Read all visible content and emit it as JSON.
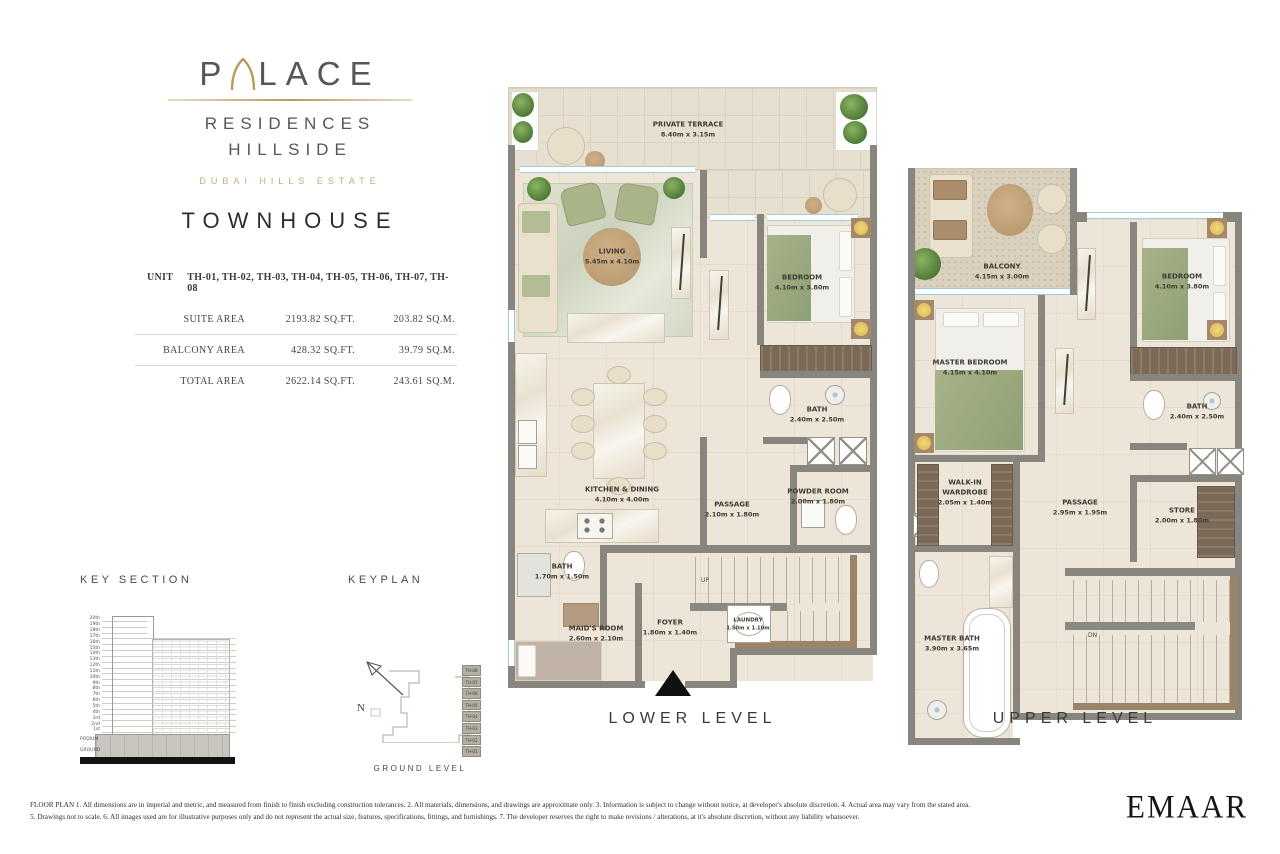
{
  "brand": {
    "logo_start": "P",
    "logo_end": "LACE",
    "line1": "RESIDENCES",
    "line2": "HILLSIDE",
    "estate": "DUBAI HILLS ESTATE",
    "product": "TOWNHOUSE"
  },
  "unit_table": {
    "unit_label": "UNIT",
    "unit_values": "TH-01, TH-02, TH-03, TH-04, TH-05, TH-06, TH-07, TH-08",
    "rows": [
      {
        "label": "SUITE AREA",
        "sqft": "2193.82 SQ.FT.",
        "sqm": "203.82 SQ.M."
      },
      {
        "label": "BALCONY AREA",
        "sqft": "428.32 SQ.FT.",
        "sqm": "39.79 SQ.M."
      },
      {
        "label": "TOTAL AREA",
        "sqft": "2622.14 SQ.FT.",
        "sqm": "243.61 SQ.M."
      }
    ]
  },
  "key_section": {
    "title": "KEY SECTION",
    "floors": [
      "20th",
      "19th",
      "18th",
      "17th",
      "16th",
      "15th",
      "14th",
      "13th",
      "12th",
      "11th",
      "10th",
      "9th",
      "8th",
      "7th",
      "6th",
      "5th",
      "4th",
      "3rd",
      "2nd",
      "1st",
      "PODIUM",
      "GROUND"
    ]
  },
  "keyplan": {
    "title": "KEYPLAN",
    "north_label": "N",
    "caption": "GROUND LEVEL",
    "units": [
      "TH-08",
      "TH-07",
      "TH-06",
      "TH-05",
      "TH-04",
      "TH-03",
      "TH-02",
      "TH-01"
    ]
  },
  "lower_level": {
    "title": "LOWER LEVEL",
    "stairs_label": "UP",
    "rooms": {
      "terrace": {
        "name": "PRIVATE TERRACE",
        "dims": "8.40m x 3.15m"
      },
      "living": {
        "name": "LIVING",
        "dims": "5.45m x 4.10m"
      },
      "bedroom": {
        "name": "BEDROOM",
        "dims": "4.10m x 3.80m"
      },
      "kitchen": {
        "name": "KITCHEN & DINING",
        "dims": "4.10m x 4.00m"
      },
      "bath": {
        "name": "BATH",
        "dims": "2.40m x 2.50m"
      },
      "powder": {
        "name": "POWDER ROOM",
        "dims": "2.00m x 1.80m"
      },
      "passage": {
        "name": "PASSAGE",
        "dims": "2.10m x 1.80m"
      },
      "bath2": {
        "name": "BATH",
        "dims": "1.70m x 1.50m"
      },
      "maids": {
        "name": "MAID'S ROOM",
        "dims": "2.60m x 2.10m"
      },
      "foyer": {
        "name": "FOYER",
        "dims": "1.80m x 1.40m"
      },
      "laundry": {
        "name": "LAUNDRY",
        "dims": "1.50m x 1.10m"
      }
    }
  },
  "upper_level": {
    "title": "UPPER LEVEL",
    "stairs_label": "DN",
    "rooms": {
      "balcony": {
        "name": "BALCONY",
        "dims": "4.15m x 3.00m"
      },
      "bedroom": {
        "name": "BEDROOM",
        "dims": "4.10m x 3.80m"
      },
      "master": {
        "name": "MASTER BEDROOM",
        "dims": "4.15m x 4.10m"
      },
      "wardrobe": {
        "name": "WALK-IN WARDROBE",
        "dims": "2.05m x 1.40m"
      },
      "passage": {
        "name": "PASSAGE",
        "dims": "2.95m x 1.95m"
      },
      "bath": {
        "name": "BATH",
        "dims": "2.40m x 2.50m"
      },
      "store": {
        "name": "STORE",
        "dims": "2.00m x 1.80m"
      },
      "masterbath": {
        "name": "MASTER BATH",
        "dims": "3.90m x 3.65m"
      }
    }
  },
  "footer": {
    "line1": "FLOOR PLAN 1. All dimensions are in imperial and metric, and measured from finish to finish excluding construction tolerances. 2. All materials, dimensions, and drawings are approximate only. 3. Information is subject to change without notice, at developer's absolute discretion. 4. Actual area may vary from the stated area.",
    "line2": "5. Drawings not to scale. 6. All images used are for illustrative purposes only and do not represent the actual size, features, specifications, fittings, and furnishings. 7. The developer reserves the right to make revisions / alterations, at it's absolute discretion, without any liability whatsoever.",
    "brand": "EMAAR"
  },
  "colors": {
    "wall": "#87857e",
    "floor": "#ece5d8",
    "terrace": "#e7e0d1",
    "accent_green": "#a9b489",
    "wood": "#9c8468",
    "gold": "#b99a5f",
    "window": "#9fcddb"
  }
}
